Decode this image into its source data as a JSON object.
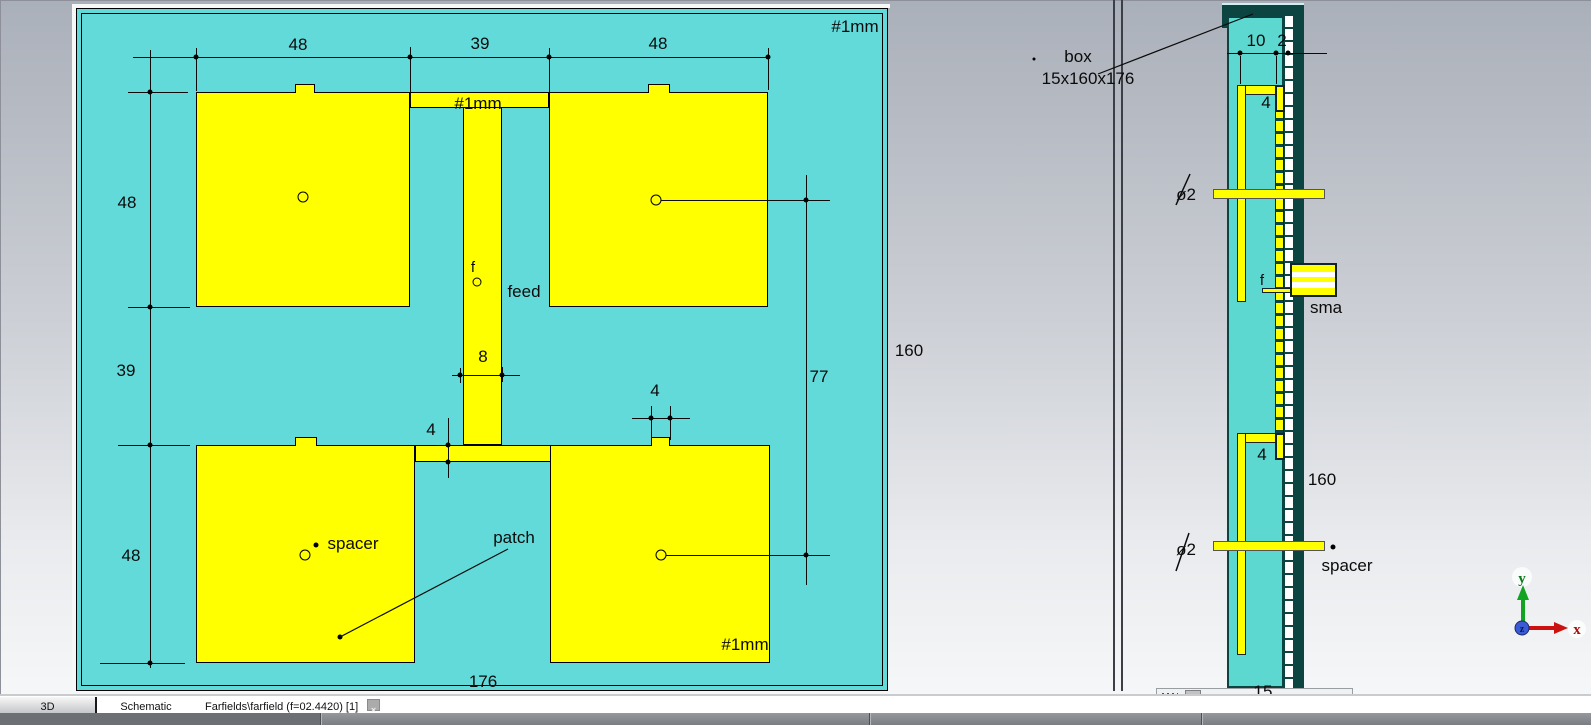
{
  "colors": {
    "board_cyan": "#63dada",
    "slab_cyan": "#5cd8d0",
    "patch_yellow": "#ffff00",
    "teal_dark": "#0c4442",
    "annotation": "#0b0b0b",
    "axis_x_red": "#cc1111",
    "axis_y_green": "#11aa22",
    "axis_z_blue": "#3355cc"
  },
  "front_view": {
    "dim_top_left": "48",
    "dim_top_mid": "39",
    "dim_top_right": "48",
    "dim_left_top": "48",
    "dim_left_mid": "39",
    "dim_left_bottom": "48",
    "dim_right_77": "77",
    "dim_height_160": "160",
    "dim_width_176": "176",
    "dim_feed_8": "8",
    "dim_stub_4": "4",
    "dim_notch_4": "4",
    "thickness_board": "#1mm",
    "thickness_feed": "#1mm",
    "thickness_patch": "#1mm",
    "feed_point": "f",
    "feed_label": "feed",
    "spacer_label": "spacer",
    "patch_label": "patch"
  },
  "side_view": {
    "box_label": "box",
    "box_size": "15x160x176",
    "dim_10": "10",
    "dim_2": "2",
    "dim_4_top": "4",
    "dim_4_bottom": "4",
    "feed_point": "f",
    "sma_label": "sma",
    "dim_160": "160",
    "dim_15": "15",
    "dia_top": "ø2",
    "dia_bottom": "ø2",
    "spacer_label": "spacer"
  },
  "axes": {
    "x": "x",
    "y": "y",
    "z": "z"
  },
  "tab_bar": {
    "tabs": [
      {
        "label": "3D",
        "active": true
      },
      {
        "label": "Schematic",
        "active": false
      },
      {
        "label": "Farfields\\farfield (f=02.4420) [1]",
        "active": false
      }
    ],
    "close_glyph": "×"
  }
}
